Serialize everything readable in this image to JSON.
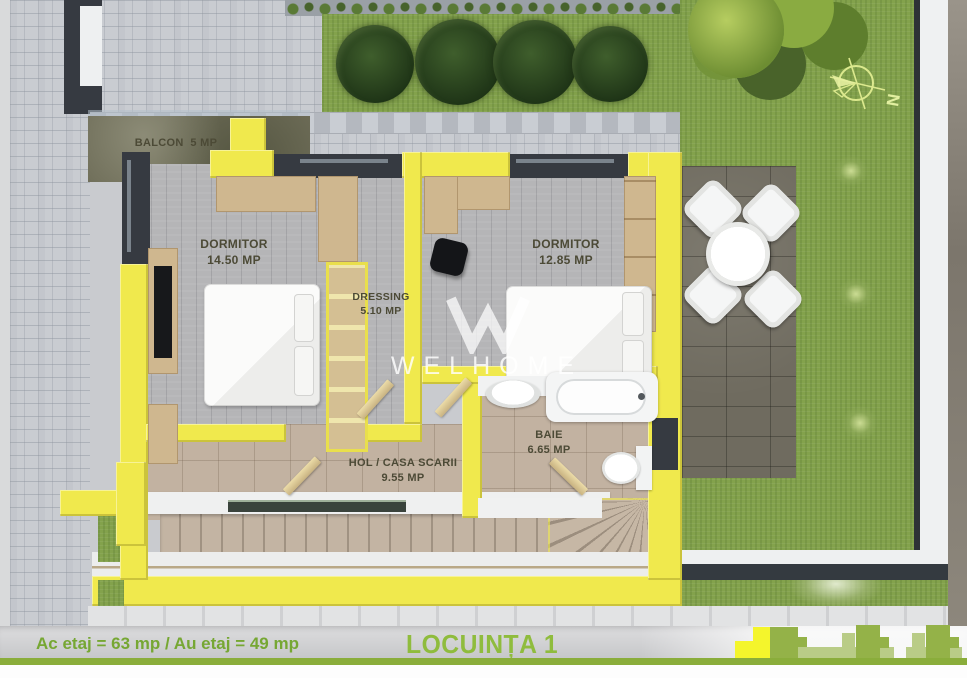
{
  "plan": {
    "rooms": {
      "balcon": {
        "name": "BALCON",
        "area": "5 MP"
      },
      "dormitor1": {
        "name": "DORMITOR",
        "area": "14.50 MP"
      },
      "dressing": {
        "name": "DRESSING",
        "area": "5.10 MP"
      },
      "dormitor2": {
        "name": "DORMITOR",
        "area": "12.85 MP"
      },
      "baie": {
        "name": "BAIE",
        "area": "6.65 MP"
      },
      "hol": {
        "name": "HOL / CASA SCARII",
        "area": "9.55 MP"
      }
    },
    "compass": {
      "label": "N"
    },
    "watermark": {
      "text": "WELHOME"
    }
  },
  "footer": {
    "area_summary": "Ac etaj = 63 mp / Au  etaj = 49 mp",
    "unit_title": "LOCUINȚA 1"
  },
  "colors": {
    "wall_yellow": "#f0e94d",
    "accent_green": "#8aad3b",
    "logo_highlight_yellow": "#f4f52c",
    "grass_green": "#83a24c",
    "label_olive": "#4c4a36"
  }
}
